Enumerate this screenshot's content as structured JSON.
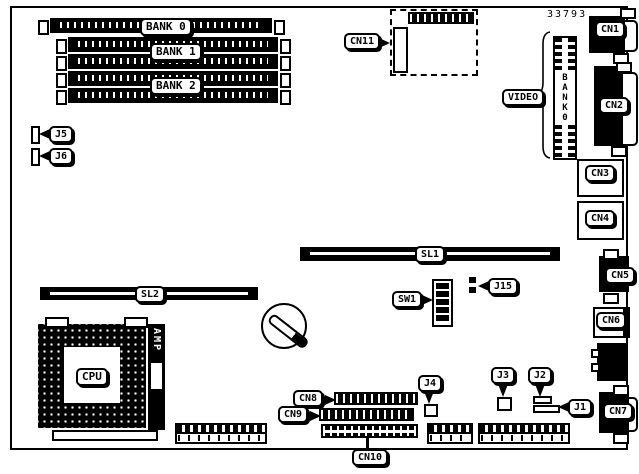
{
  "diagram": {
    "part_number": "33793",
    "labels": {
      "bank0": "BANK 0",
      "bank1": "BANK 1",
      "bank2": "BANK 2",
      "video": "VIDEO",
      "cn1": "CN1",
      "cn2": "CN2",
      "cn3": "CN3",
      "cn4": "CN4",
      "cn5": "CN5",
      "cn6": "CN6",
      "cn7": "CN7",
      "cn8": "CN8",
      "cn9": "CN9",
      "cn10": "CN10",
      "cn11": "CN11",
      "j1": "J1",
      "j2": "J2",
      "j3": "J3",
      "j4": "J4",
      "j5": "J5",
      "j6": "J6",
      "j15": "J15",
      "sl1": "SL1",
      "sl2": "SL2",
      "sw1": "SW1",
      "cpu": "CPU",
      "amp": "AMP"
    },
    "vertical_bank_letters": [
      "B",
      "A",
      "N",
      "K",
      "0"
    ]
  }
}
